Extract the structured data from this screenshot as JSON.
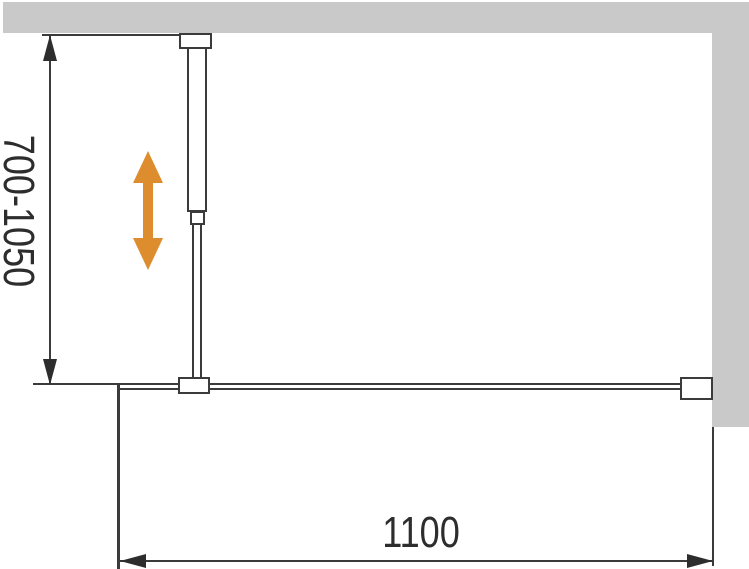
{
  "diagram": {
    "type": "technical-dimension-drawing",
    "subject": "walk-in shower glass screen, top view, with adjustable wall support bar",
    "vertical_dimension": {
      "label": "700-1050"
    },
    "horizontal_dimension": {
      "label": "1100"
    },
    "colors": {
      "background": "#ffffff",
      "wall_fill": "#c9c9c9",
      "line": "#3b3b3b",
      "dimension_text": "#2d2d2d",
      "adjust_arrow": "#dd8d2e"
    },
    "icons": {
      "adjust_arrow": "double-headed-vertical-arrow"
    }
  }
}
